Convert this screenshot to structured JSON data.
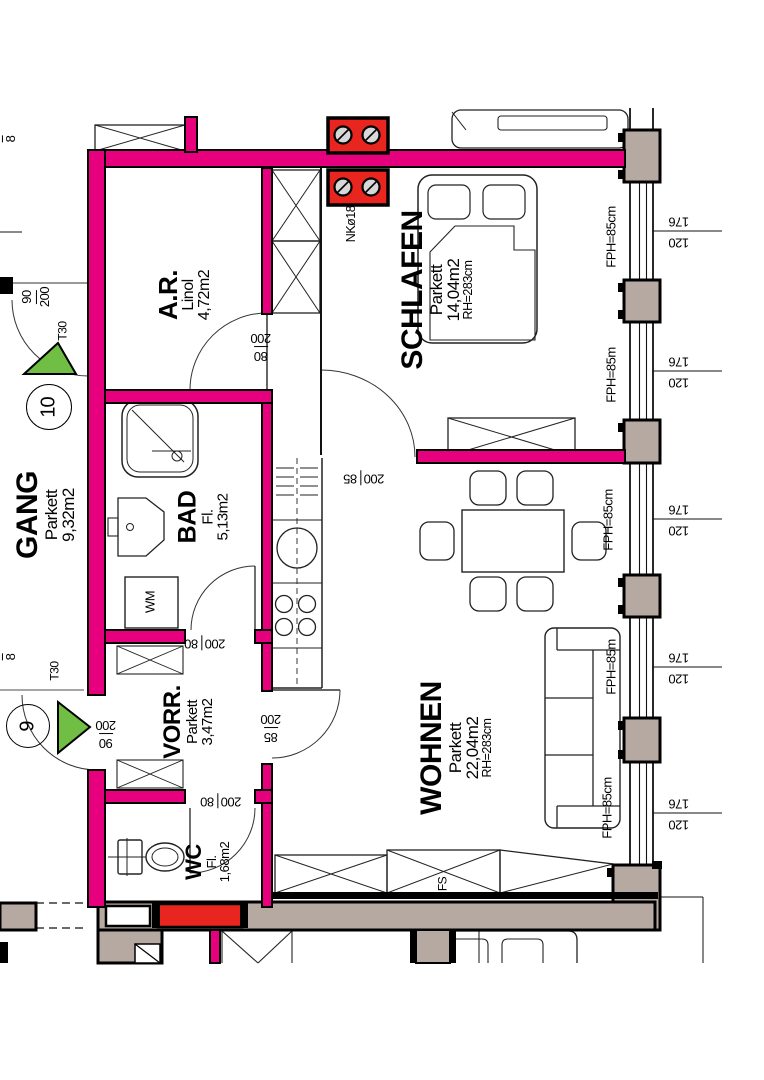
{
  "plan": {
    "rooms": {
      "gang": {
        "name": "GANG",
        "floor": "Parkett",
        "area": "9,32m2"
      },
      "ar": {
        "name": "A.R.",
        "floor": "Linol",
        "area": "4,72m2"
      },
      "schlafen": {
        "name": "SCHLAFEN",
        "floor": "Parkett",
        "area": "14,04m2",
        "height": "RH=283cm"
      },
      "bad": {
        "name": "BAD",
        "floor": "Fl.",
        "area": "5,13m2"
      },
      "vorr": {
        "name": "VORR.",
        "floor": "Parkett",
        "area": "3,47m2"
      },
      "wc": {
        "name": "WC",
        "floor": "Fl.",
        "area": "1,68m2"
      },
      "wohnen": {
        "name": "WOHNEN",
        "floor": "Parkett",
        "area": "22,04m2",
        "height": "RH=283cm"
      }
    },
    "doors": {
      "d10": {
        "number": "10",
        "size_a": "90",
        "size_b": "200",
        "type": "T30"
      },
      "d9": {
        "number": "9",
        "size_a": "90",
        "size_b": "200",
        "type": "T30"
      },
      "ar_door": {
        "size_a": "80",
        "size_b": "200"
      },
      "schlafen_door": {
        "size_a": "200",
        "size_b": "85"
      },
      "bad_door": {
        "size_a": "200",
        "size_b": "80"
      },
      "wc_door": {
        "size_a": "200",
        "size_b": "80"
      },
      "vorr_wohnen": {
        "size_a": "85",
        "size_b": "200"
      }
    },
    "windows": [
      {
        "fph": "FPH=85cm",
        "w": "176",
        "h": "120"
      },
      {
        "fph": "FPH=85m",
        "w": "176",
        "h": "120"
      },
      {
        "fph": "FPH=85cm",
        "w": "176",
        "h": "120"
      },
      {
        "fph": "FPH=85m",
        "w": "176",
        "h": "120"
      },
      {
        "fph": "FPH=85cm",
        "w": "176",
        "h": "120"
      }
    ],
    "labels": {
      "shaft": "NKø18",
      "washing_machine": "WM",
      "wardrobe_fs": "FS"
    },
    "edge_dims": {
      "top": {
        "a": "2",
        "b": "8"
      },
      "mid": {
        "a": "2",
        "b": "8"
      }
    },
    "colors": {
      "wall": "#E6007E",
      "accent_red": "#E8251F",
      "marker_green": "#70BF44",
      "masonry": "#B6A9A1"
    }
  }
}
